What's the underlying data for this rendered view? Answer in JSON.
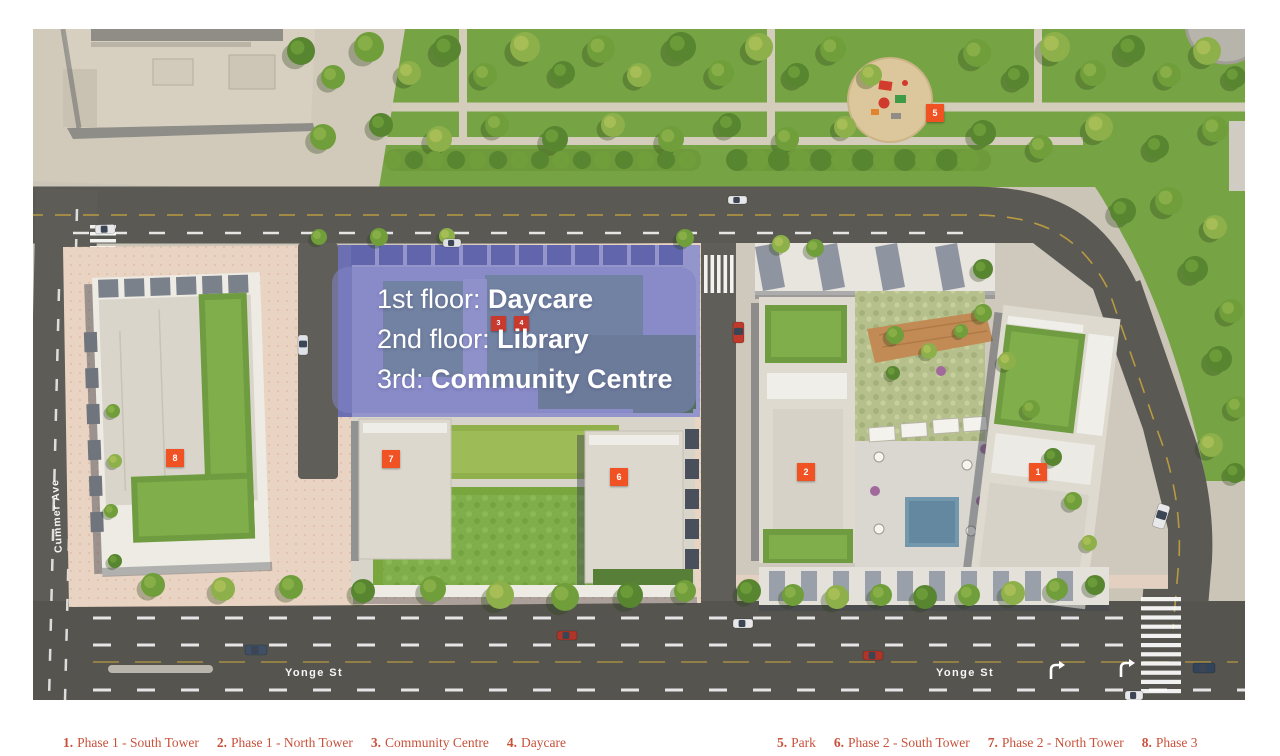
{
  "map": {
    "streets": {
      "cummer": "Cummer Ave",
      "yonge_west": "Yonge St",
      "yonge_east": "Yonge St"
    },
    "overlay": {
      "lines": [
        {
          "prefix": "1st floor: ",
          "bold": "Daycare"
        },
        {
          "prefix": "2nd floor: ",
          "bold": "Library"
        },
        {
          "prefix": "3rd: ",
          "bold": "Community Centre"
        }
      ]
    },
    "markers": [
      {
        "label": "1"
      },
      {
        "label": "2"
      },
      {
        "label": "3"
      },
      {
        "label": "4"
      },
      {
        "label": "5"
      },
      {
        "label": "6"
      },
      {
        "label": "7"
      },
      {
        "label": "8"
      }
    ]
  },
  "legend": {
    "left": [
      {
        "num": "1.",
        "label": "Phase 1 - South Tower"
      },
      {
        "num": "2.",
        "label": "Phase 1 - North Tower"
      },
      {
        "num": "3.",
        "label": "Community Centre"
      },
      {
        "num": "4.",
        "label": "Daycare"
      }
    ],
    "right": [
      {
        "num": "5.",
        "label": "Park"
      },
      {
        "num": "6.",
        "label": "Phase 2 - South Tower"
      },
      {
        "num": "7.",
        "label": "Phase 2 - North Tower"
      },
      {
        "num": "8.",
        "label": "Phase 3"
      }
    ]
  },
  "colors": {
    "marker_orange": "#f05223",
    "marker_red": "#c8392e",
    "overlay_purple": "#8183c7",
    "legend_text": "#c8513a",
    "park_green": "#76a344",
    "road_gray": "#5a5954"
  }
}
